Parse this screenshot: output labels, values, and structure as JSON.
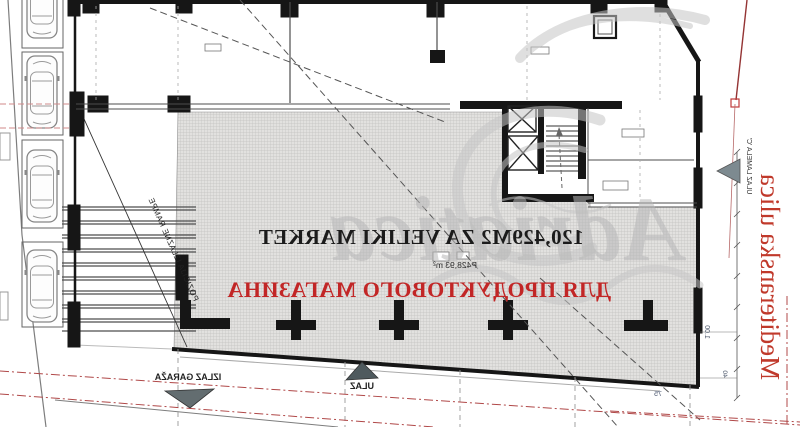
{
  "drawing": {
    "kind": "architectural ground-floor plan (mirrored print)",
    "parking_spaces_visible": 4
  },
  "labels": {
    "market_area_line1": "120,429M2 ZA VELIKI MARKET",
    "market_area_sub": "P428,93 m²",
    "market_area_line2": "ДЛЯ ПРОДУКТОВОГО МАГАЗИНА",
    "street_name": "Mediteranska ulica",
    "ramp_note": "POZICIJA IZLAZNE RAMPE",
    "garage_exit": "IZLAZ GARAŽA",
    "entrance": "ULAZ",
    "block_entrance": "ULAZ LAMELA 'C'",
    "dim_100": "1.00",
    "dim_40": "40",
    "dim_75": "75"
  },
  "watermark": {
    "text": "Adriatica"
  },
  "colors": {
    "red_text": "#c0392b",
    "cyrillic_red": "#c22626",
    "boundary_red": "#b04848",
    "wall_black": "#161616",
    "hatch_gray": "#dedddb",
    "watermark_gray": "#b7b7b7"
  }
}
